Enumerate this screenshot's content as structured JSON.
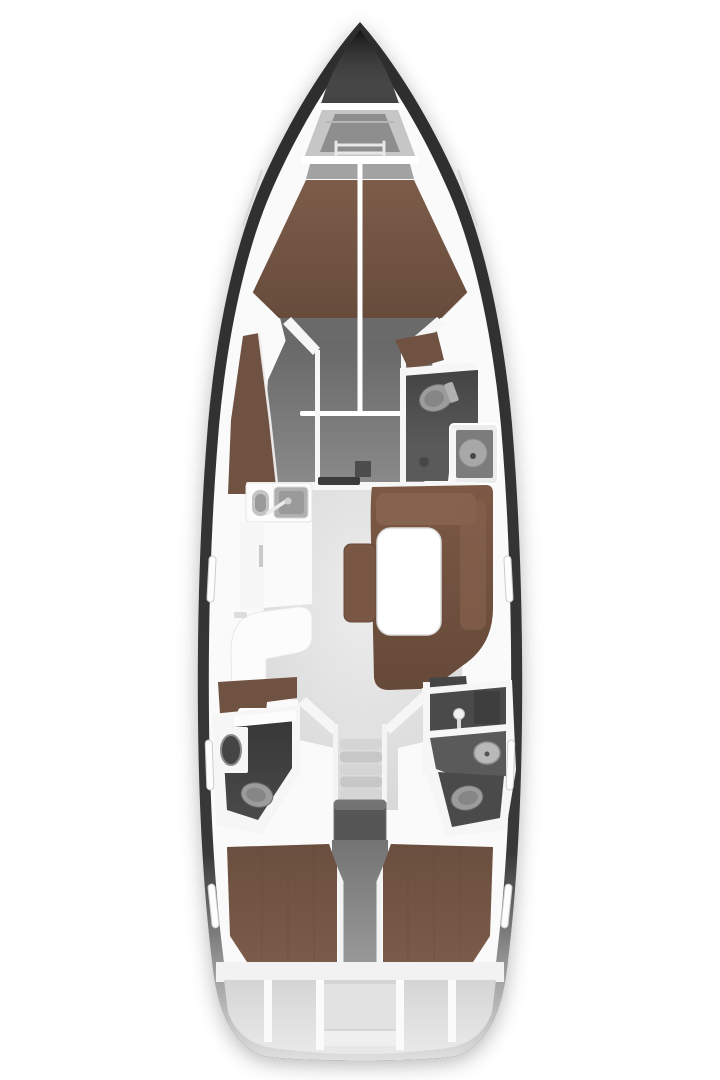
{
  "meta": {
    "description": "Top-down interior layout plan of a sailing yacht, bow pointing up"
  },
  "palette": {
    "background": "#ffffff",
    "hull": "#2e2e2e",
    "deck": "#fafafa",
    "bow_tip": "#2a2a2a",
    "locker_wall": "#c6c6c6",
    "locker_floor": "#8e8e8e",
    "sill": "#ffffff",
    "berth_head_band": "#a2a2a2",
    "wood_vberth": "#7d5c49",
    "wood_chaise": "#6f5242",
    "foot_band": "#6a6a6a",
    "fwd_floor": "#8a8a8a",
    "hatch": "#4c4c4c",
    "wall": "#f6f6f6",
    "head_floor": "#5a5a5a",
    "head_floor_dark": "#4a4a4a",
    "toilet": "#9c9c9c",
    "toilet_inner": "#868686",
    "shower_panel": "#7c7c7c",
    "shower_pan": "#a8a8a8",
    "drain": "#474747",
    "slot": "#3b3b3b",
    "galley_white": "#fcfcfc",
    "basin_small": "#c4c4c4",
    "basin_large": "#b0b0b0",
    "basin_inner": "#9a9a9a",
    "counter": "#f7f7f7",
    "wood_sofa": "#7c5945",
    "sofa_cushion": "#86634e",
    "table": "#ffffff",
    "wood_bench": "#7a5744",
    "locker_dark": "#454545",
    "salon_floor": "#d6d6d6",
    "sink_dark": "#454545",
    "fixture_light": "#b9b9b9",
    "shower_locker": "#3e3e3e",
    "showerhead": "#f2f2f2",
    "step_landing": "#e2e2e2",
    "step_a": "#d5d5d5",
    "step_b": "#c7c7c7",
    "rail": "#f4f4f4",
    "engine": "#565656",
    "corridor": "#9a9a9a",
    "wood_aft": "#7b5b49",
    "stern_band": "#f2f2f2",
    "stern_panel": "#e9e9e9",
    "stern_inner": "#e2e2e2",
    "stern_shelf": "#efefef",
    "slit": "#fdfdfd"
  },
  "regions": {
    "list": [
      "bow-anchor-locker",
      "chain-locker",
      "owner-cabin-v-berth",
      "port-chaise-locker",
      "forward-head",
      "forward-shower",
      "galley",
      "galley-sink",
      "saloon",
      "settee",
      "saloon-table",
      "center-bench",
      "port-head",
      "starboard-head",
      "companionway-steps",
      "engine-compartment",
      "port-aft-cabin",
      "starboard-aft-cabin",
      "transom-lockers"
    ]
  }
}
